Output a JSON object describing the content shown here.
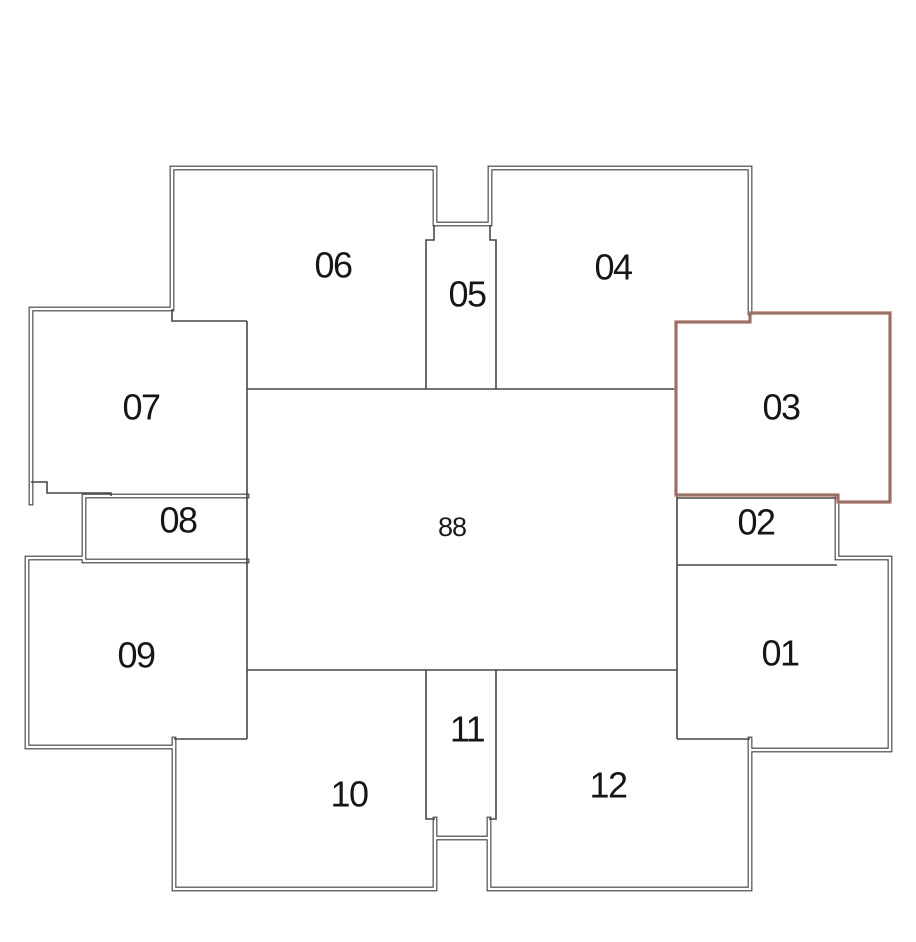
{
  "plan": {
    "name": "floor-plate-unit-selector",
    "highlighted_room": "03",
    "core_area": {
      "label": "88"
    },
    "colors": {
      "wall": "#3e3e3e",
      "interior_wall": "#474747",
      "highlight_light": "#c08377",
      "highlight_dark": "#5f322b",
      "label_text": "#161616",
      "background": "#ffffff"
    },
    "rooms": [
      {
        "id": "01",
        "label": "01"
      },
      {
        "id": "02",
        "label": "02"
      },
      {
        "id": "03",
        "label": "03"
      },
      {
        "id": "04",
        "label": "04"
      },
      {
        "id": "05",
        "label": "05"
      },
      {
        "id": "06",
        "label": "06"
      },
      {
        "id": "07",
        "label": "07"
      },
      {
        "id": "08",
        "label": "08"
      },
      {
        "id": "09",
        "label": "09"
      },
      {
        "id": "10",
        "label": "10"
      },
      {
        "id": "11",
        "label": "11"
      },
      {
        "id": "12",
        "label": "12"
      }
    ]
  }
}
